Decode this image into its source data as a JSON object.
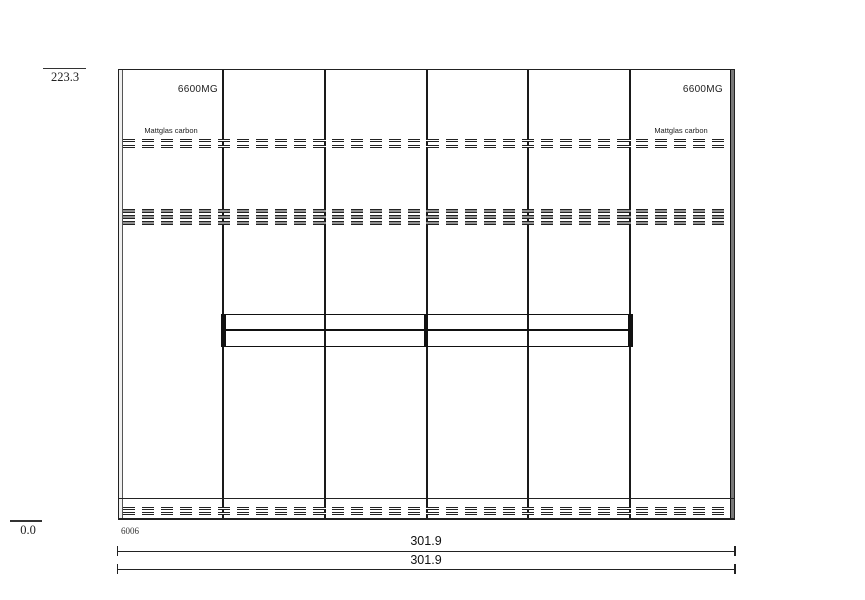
{
  "colors": {
    "line": "#1a1a1a",
    "background": "#ffffff"
  },
  "levels": {
    "top": "223.3",
    "bottom": "0.0"
  },
  "plinth_code": "6006",
  "dimensions": {
    "width_upper": "301.9",
    "width_lower": "301.9"
  },
  "doors": {
    "left": {
      "model": "6600MG",
      "finish": "Mattglas carbon"
    },
    "right": {
      "model": "6600MG",
      "finish": "Mattglas carbon"
    }
  }
}
